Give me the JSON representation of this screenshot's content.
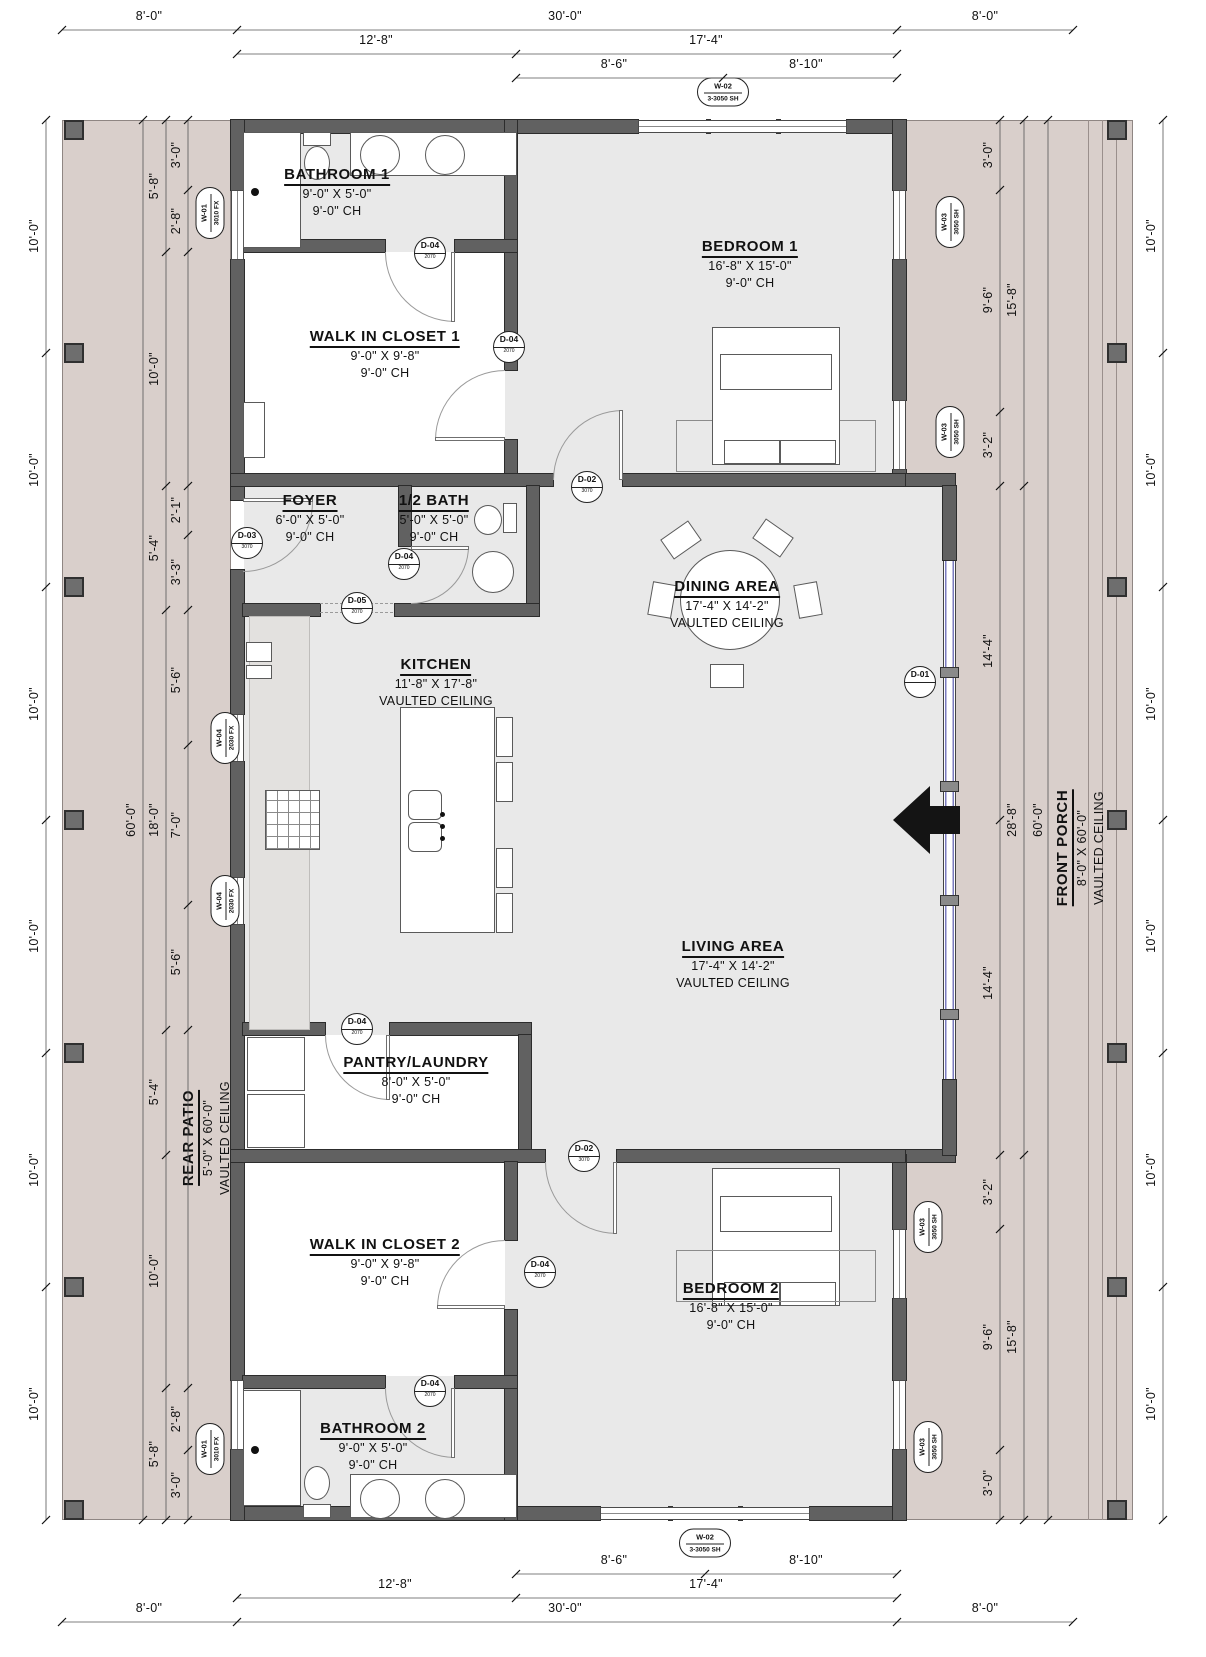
{
  "rooms": [
    {
      "id": "bathroom1",
      "name": "BATHROOM 1",
      "size": "9'-0\" X 5'-0\"",
      "ceiling": "9'-0\" CH"
    },
    {
      "id": "closet1",
      "name": "WALK IN CLOSET 1",
      "size": "9'-0\" X 9'-8\"",
      "ceiling": "9'-0\" CH"
    },
    {
      "id": "bedroom1",
      "name": "BEDROOM 1",
      "size": "16'-8\" X 15'-0\"",
      "ceiling": "9'-0\" CH"
    },
    {
      "id": "foyer",
      "name": "FOYER",
      "size": "6'-0\" X 5'-0\"",
      "ceiling": "9'-0\" CH"
    },
    {
      "id": "halfbath",
      "name": "1/2 BATH",
      "size": "5'-0\" X 5'-0\"",
      "ceiling": "9'-0\" CH"
    },
    {
      "id": "dining",
      "name": "DINING AREA",
      "size": "17'-4\" X 14'-2\"",
      "ceiling": "VAULTED CEILING"
    },
    {
      "id": "kitchen",
      "name": "KITCHEN",
      "size": "11'-8\" X 17'-8\"",
      "ceiling": "VAULTED CEILING"
    },
    {
      "id": "living",
      "name": "LIVING AREA",
      "size": "17'-4\" X 14'-2\"",
      "ceiling": "VAULTED CEILING"
    },
    {
      "id": "pantry",
      "name": "PANTRY/LAUNDRY",
      "size": "8'-0\" X 5'-0\"",
      "ceiling": "9'-0\" CH"
    },
    {
      "id": "closet2",
      "name": "WALK IN CLOSET 2",
      "size": "9'-0\" X 9'-8\"",
      "ceiling": "9'-0\" CH"
    },
    {
      "id": "bathroom2",
      "name": "BATHROOM 2",
      "size": "9'-0\" X 5'-0\"",
      "ceiling": "9'-0\" CH"
    },
    {
      "id": "bedroom2",
      "name": "BEDROOM 2",
      "size": "16'-8\" X 15'-0\"",
      "ceiling": "9'-0\" CH"
    },
    {
      "id": "rearpatio",
      "name": "REAR PATIO",
      "size": "5'-0\" X 60'-0\"",
      "ceiling": "VAULTED CEILING"
    },
    {
      "id": "frontporch",
      "name": "FRONT PORCH",
      "size": "8'-0\" X 60'-0\"",
      "ceiling": "VAULTED CEILING"
    }
  ],
  "doors": [
    {
      "label": "D-01",
      "sub": "",
      "x": 920,
      "y": 682
    },
    {
      "label": "D-02",
      "sub": "3070",
      "x": 587,
      "y": 487
    },
    {
      "label": "D-03",
      "sub": "3070",
      "x": 247,
      "y": 543
    },
    {
      "label": "D-04",
      "sub": "2070",
      "x": 430,
      "y": 253
    },
    {
      "label": "D-04",
      "sub": "2070",
      "x": 509,
      "y": 347
    },
    {
      "label": "D-04",
      "sub": "2070",
      "x": 404,
      "y": 564
    },
    {
      "label": "D-05",
      "sub": "2070",
      "x": 357,
      "y": 608
    },
    {
      "label": "D-04",
      "sub": "2070",
      "x": 357,
      "y": 1029
    },
    {
      "label": "D-02",
      "sub": "3070",
      "x": 584,
      "y": 1156
    },
    {
      "label": "D-04",
      "sub": "2070",
      "x": 540,
      "y": 1272
    },
    {
      "label": "D-04",
      "sub": "2070",
      "x": 430,
      "y": 1391
    }
  ],
  "windows": [
    {
      "label": "W-02",
      "sub": "3-3050 SH",
      "x": 723,
      "y": 92,
      "v": 0
    },
    {
      "label": "W-01",
      "sub": "3010 FX",
      "x": 210,
      "y": 213,
      "v": 1
    },
    {
      "label": "W-03",
      "sub": "3050 SH",
      "x": 950,
      "y": 222,
      "v": 1
    },
    {
      "label": "W-03",
      "sub": "3050 SH",
      "x": 950,
      "y": 432,
      "v": 1
    },
    {
      "label": "W-04",
      "sub": "2030 FX",
      "x": 225,
      "y": 738,
      "v": 1
    },
    {
      "label": "W-04",
      "sub": "2030 FX",
      "x": 225,
      "y": 901,
      "v": 1
    },
    {
      "label": "W-03",
      "sub": "3050 SH",
      "x": 928,
      "y": 1227,
      "v": 1
    },
    {
      "label": "W-03",
      "sub": "3050 SH",
      "x": 928,
      "y": 1447,
      "v": 1
    },
    {
      "label": "W-01",
      "sub": "3010 FX",
      "x": 210,
      "y": 1449,
      "v": 1
    },
    {
      "label": "W-02",
      "sub": "3-3050 SH",
      "x": 705,
      "y": 1543,
      "v": 0
    }
  ],
  "dims": [
    {
      "t": "8'-0\"",
      "x": 149,
      "y": 16
    },
    {
      "t": "30'-0\"",
      "x": 565,
      "y": 16
    },
    {
      "t": "8'-0\"",
      "x": 985,
      "y": 16
    },
    {
      "t": "12'-8\"",
      "x": 376,
      "y": 40
    },
    {
      "t": "17'-4\"",
      "x": 706,
      "y": 40
    },
    {
      "t": "8'-6\"",
      "x": 614,
      "y": 64
    },
    {
      "t": "8'-10\"",
      "x": 806,
      "y": 64
    },
    {
      "t": "8'-6\"",
      "x": 614,
      "y": 1560
    },
    {
      "t": "8'-10\"",
      "x": 806,
      "y": 1560
    },
    {
      "t": "12'-8\"",
      "x": 395,
      "y": 1584
    },
    {
      "t": "17'-4\"",
      "x": 706,
      "y": 1584
    },
    {
      "t": "8'-0\"",
      "x": 149,
      "y": 1608
    },
    {
      "t": "30'-0\"",
      "x": 565,
      "y": 1608
    },
    {
      "t": "8'-0\"",
      "x": 985,
      "y": 1608
    },
    {
      "t": "10'-0\"",
      "x": 34,
      "y": 236,
      "v": 1
    },
    {
      "t": "10'-0\"",
      "x": 34,
      "y": 470,
      "v": 1
    },
    {
      "t": "10'-0\"",
      "x": 34,
      "y": 704,
      "v": 1
    },
    {
      "t": "10'-0\"",
      "x": 34,
      "y": 936,
      "v": 1
    },
    {
      "t": "10'-0\"",
      "x": 34,
      "y": 1170,
      "v": 1
    },
    {
      "t": "10'-0\"",
      "x": 34,
      "y": 1404,
      "v": 1
    },
    {
      "t": "60'-0\"",
      "x": 131,
      "y": 820,
      "v": 1
    },
    {
      "t": "5'-8\"",
      "x": 154,
      "y": 186,
      "v": 1
    },
    {
      "t": "10'-0\"",
      "x": 154,
      "y": 369,
      "v": 1
    },
    {
      "t": "5'-4\"",
      "x": 154,
      "y": 548,
      "v": 1
    },
    {
      "t": "18'-0\"",
      "x": 154,
      "y": 820,
      "v": 1
    },
    {
      "t": "5'-4\"",
      "x": 154,
      "y": 1092,
      "v": 1
    },
    {
      "t": "10'-0\"",
      "x": 154,
      "y": 1271,
      "v": 1
    },
    {
      "t": "5'-8\"",
      "x": 154,
      "y": 1454,
      "v": 1
    },
    {
      "t": "3'-0\"",
      "x": 176,
      "y": 155,
      "v": 1
    },
    {
      "t": "2'-8\"",
      "x": 176,
      "y": 221,
      "v": 1
    },
    {
      "t": "2'-1\"",
      "x": 176,
      "y": 510,
      "v": 1
    },
    {
      "t": "3'-3\"",
      "x": 176,
      "y": 572,
      "v": 1
    },
    {
      "t": "5'-6\"",
      "x": 176,
      "y": 680,
      "v": 1
    },
    {
      "t": "7'-0\"",
      "x": 176,
      "y": 825,
      "v": 1
    },
    {
      "t": "5'-6\"",
      "x": 176,
      "y": 962,
      "v": 1
    },
    {
      "t": "2'-8\"",
      "x": 176,
      "y": 1419,
      "v": 1
    },
    {
      "t": "3'-0\"",
      "x": 176,
      "y": 1485,
      "v": 1
    },
    {
      "t": "3'-0\"",
      "x": 988,
      "y": 155,
      "v": 1
    },
    {
      "t": "9'-6\"",
      "x": 988,
      "y": 300,
      "v": 1
    },
    {
      "t": "3'-2\"",
      "x": 988,
      "y": 445,
      "v": 1
    },
    {
      "t": "14'-4\"",
      "x": 988,
      "y": 651,
      "v": 1
    },
    {
      "t": "14'-4\"",
      "x": 988,
      "y": 983,
      "v": 1
    },
    {
      "t": "3'-2\"",
      "x": 988,
      "y": 1192,
      "v": 1
    },
    {
      "t": "9'-6\"",
      "x": 988,
      "y": 1337,
      "v": 1
    },
    {
      "t": "3'-0\"",
      "x": 988,
      "y": 1483,
      "v": 1
    },
    {
      "t": "15'-8\"",
      "x": 1012,
      "y": 300,
      "v": 1
    },
    {
      "t": "28'-8\"",
      "x": 1012,
      "y": 820,
      "v": 1
    },
    {
      "t": "15'-8\"",
      "x": 1012,
      "y": 1337,
      "v": 1
    },
    {
      "t": "60'-0\"",
      "x": 1038,
      "y": 820,
      "v": 1
    },
    {
      "t": "10'-0\"",
      "x": 1151,
      "y": 236,
      "v": 1
    },
    {
      "t": "10'-0\"",
      "x": 1151,
      "y": 470,
      "v": 1
    },
    {
      "t": "10'-0\"",
      "x": 1151,
      "y": 704,
      "v": 1
    },
    {
      "t": "10'-0\"",
      "x": 1151,
      "y": 936,
      "v": 1
    },
    {
      "t": "10'-0\"",
      "x": 1151,
      "y": 1170,
      "v": 1
    },
    {
      "t": "10'-0\"",
      "x": 1151,
      "y": 1404,
      "v": 1
    }
  ],
  "colors": {
    "wall": "#616161",
    "floor": "#e9e9e9",
    "patio": "#d9cfcb",
    "glazing": "#7b7bbf",
    "text": "#111111"
  }
}
